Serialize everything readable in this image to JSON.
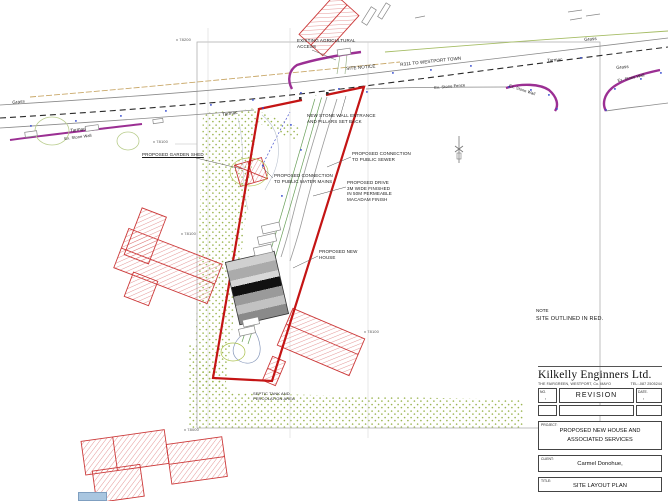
{
  "note": {
    "heading": "NOTE",
    "body": "SITE OUTLINED IN RED."
  },
  "title_block": {
    "company": "Kilkelly Enginners Ltd.",
    "address": "THE FAIRGREEN, WESTPORT, Co. MAYO",
    "tel": "TEL:-087 2505244",
    "revision": {
      "no_label": "NO.",
      "revision_label": "REVISION",
      "date_label": "DATE.",
      "no_value": ",",
      "date_value": ","
    },
    "project_label": "PROJECT:",
    "project": "PROPOSED NEW HOUSE AND\nASSOCIATED SERVICES",
    "client_label": "CLIENT:",
    "client": "Carmel Donohue,",
    "title_label": "TITLE:",
    "title": "SITE LAYOUT PLAN"
  },
  "plan_labels": {
    "existing_agricultural_access": "EXISTING AGRICULTURAL\nACCESS",
    "site_notice": "SITE NOTICE",
    "new_stone_wall": "NEW STONE WALL ENTRANCE\nAND PILLARS SET BACK",
    "connection_sewer": "PROPOSED CONNECTION\nTO PUBLIC SEWER",
    "proposed_drive": "PROPOSED DRIVE\n3M WIDE FINISHED\nIN 50M PERMEABLE\nMACADAM FINISH",
    "garden_shed": "PROPOSED GARDEN SHED",
    "connection_water": "PROPOSED CONNECTION\nTO PUBLIC WATER MAINS",
    "proposed_new_house": "PROPOSED NEW\nHOUSE",
    "septic": "SEPTIC TANK AND\nPERCOLATION AREA",
    "road_name": "R311 TO WESTPORT TOWN",
    "grass": "Grass",
    "tarmac": "Tarmac",
    "ex_stone_wall": "Ex. Stone Wall",
    "ex_stone_fence": "Ex. Stone Fence",
    "grid_78200": "x 78200",
    "grid_78100": "x 78100",
    "grid_78000": "x 78000"
  },
  "colors": {
    "site_outline": "#c41414",
    "existing_building_hatch": "#d15050",
    "stone_wall": "#9b2f93",
    "vegetation_dots": "#9bb551",
    "road_centerline": "#2a2a2a"
  }
}
